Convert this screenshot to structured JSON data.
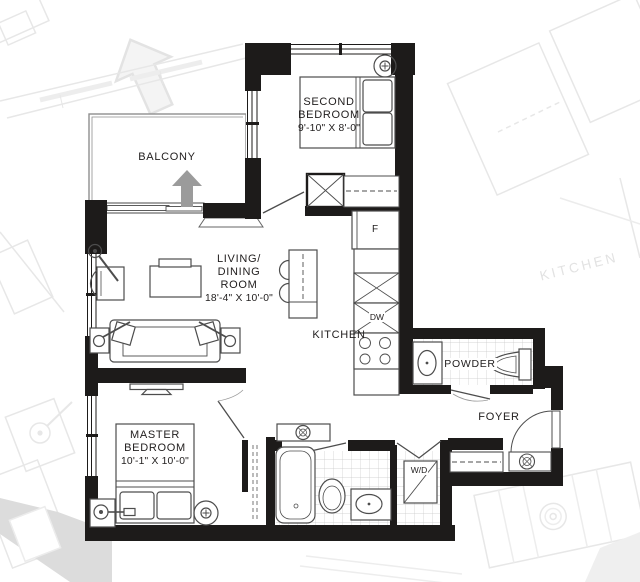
{
  "plan_title": "Apartment floor plan",
  "colors": {
    "wall": "#1d1b1a",
    "furniture_line": "#4d4d4d",
    "tile_line": "#c8c8c8",
    "background_plan": "#e6e6e6",
    "label": "#232020",
    "direction_arrow": "#9b9b9b"
  },
  "rooms": {
    "balcony": {
      "label": "BALCONY"
    },
    "second_bedroom": {
      "name_line1": "SECOND",
      "name_line2": "BEDROOM",
      "dimensions": "9'-10\" x 8'-0\""
    },
    "living_dining": {
      "name_line1": "LIVING/",
      "name_line2": "DINING",
      "name_line3": "ROOM",
      "dimensions": "18'-4\" x 10'-0\""
    },
    "kitchen": {
      "label": "KITCHEN"
    },
    "powder_room": {
      "label": "POWDER"
    },
    "foyer": {
      "label": "FOYER"
    },
    "master_bedroom": {
      "name_line1": "MASTER",
      "name_line2": "BEDROOM",
      "dimensions": "10'-1\" x 10'-0\""
    }
  },
  "appliances": {
    "fridge_label": "F",
    "dishwasher_label": "DW",
    "washer_dryer_label": "W/D"
  },
  "background_plan": {
    "neighbor_kitchen_label": "KITCHEN"
  }
}
